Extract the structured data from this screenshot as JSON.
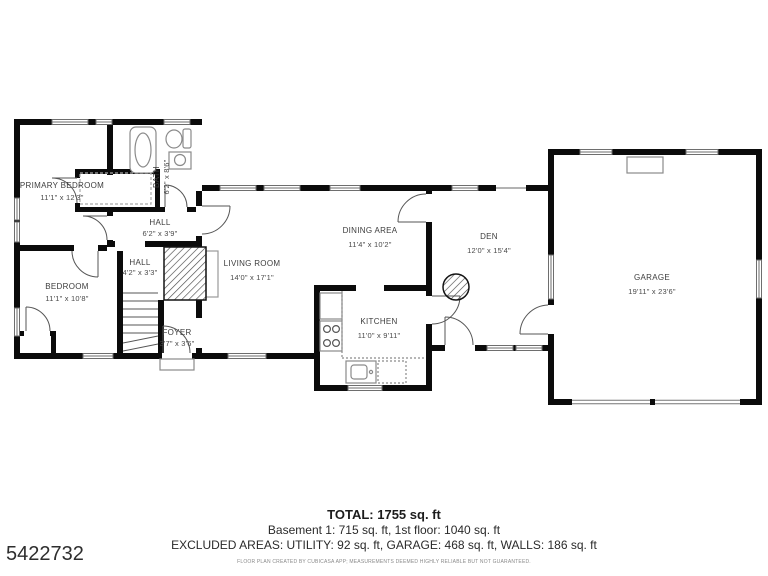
{
  "page": {
    "listing_id": "5422732",
    "colors": {
      "wall": "#0b0b0b",
      "label": "#3d3d3d",
      "fixture": "#8a8a8a",
      "background": "#ffffff"
    }
  },
  "rooms": [
    {
      "id": "primary-bedroom",
      "name": "PRIMARY BEDROOM",
      "dims": "11'1\" x 12'3\""
    },
    {
      "id": "bath",
      "name": "BATH",
      "dims": "6'2\" x 8'6\""
    },
    {
      "id": "hall-upper",
      "name": "HALL",
      "dims": "6'2\" x 3'9\""
    },
    {
      "id": "hall-lower",
      "name": "HALL",
      "dims": "4'2\" x 3'3\""
    },
    {
      "id": "bedroom",
      "name": "BEDROOM",
      "dims": "11'1\" x 10'8\""
    },
    {
      "id": "foyer",
      "name": "FOYER",
      "dims": "3'7\" x 3'6\""
    },
    {
      "id": "living-room",
      "name": "LIVING ROOM",
      "dims": "14'0\" x 17'1\""
    },
    {
      "id": "dining-area",
      "name": "DINING AREA",
      "dims": "11'4\" x 10'2\""
    },
    {
      "id": "kitchen",
      "name": "KITCHEN",
      "dims": "11'0\" x 9'11\""
    },
    {
      "id": "den",
      "name": "DEN",
      "dims": "12'0\" x 15'4\""
    },
    {
      "id": "garage",
      "name": "GARAGE",
      "dims": "19'11\" x 23'6\""
    }
  ],
  "summary": {
    "total": "TOTAL: 1755 sq. ft",
    "floors": "Basement 1: 715 sq. ft, 1st floor: 1040 sq. ft",
    "excluded": "EXCLUDED AREAS: UTILITY: 92 sq. ft, GARAGE: 468 sq. ft, WALLS: 186 sq. ft",
    "disclaimer": "FLOOR PLAN CREATED BY CUBICASA APP; MEASUREMENTS DEEMED HIGHLY RELIABLE BUT NOT GUARANTEED."
  }
}
